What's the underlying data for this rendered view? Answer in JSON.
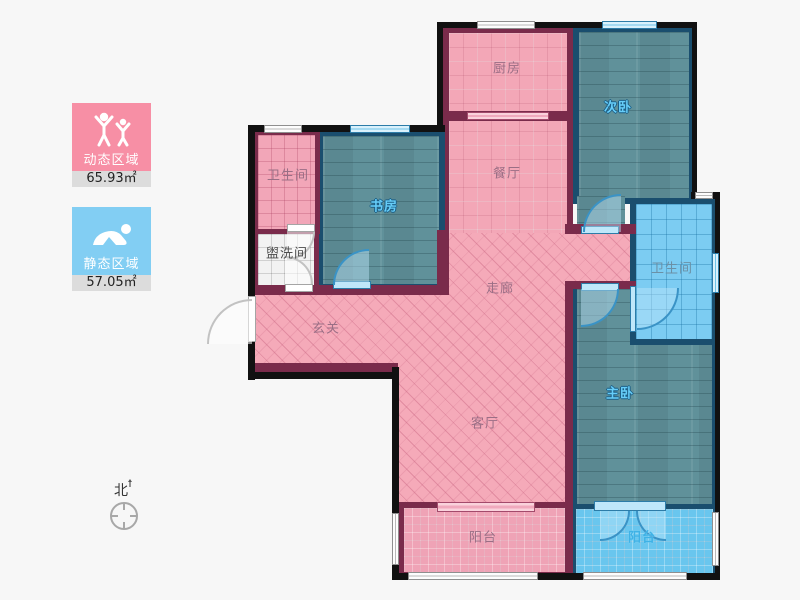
{
  "legend": {
    "dynamic": {
      "label": "动态区域",
      "area": "65.93㎡",
      "color": "#f78fa5",
      "icon": "people-active-icon"
    },
    "static": {
      "label": "静态区域",
      "area": "57.05㎡",
      "color": "#82cef3",
      "icon": "person-resting-icon"
    }
  },
  "compass": {
    "north_label": "北"
  },
  "rooms": {
    "kitchen": {
      "label": "厨房"
    },
    "dining": {
      "label": "餐厅"
    },
    "bedroom_second": {
      "label": "次卧"
    },
    "bathroom_top": {
      "label": "卫生间"
    },
    "study": {
      "label": "书房"
    },
    "washroom": {
      "label": "盥洗间"
    },
    "corridor": {
      "label": "走廊"
    },
    "entry": {
      "label": "玄关"
    },
    "bathroom_right": {
      "label": "卫生间"
    },
    "living": {
      "label": "客厅"
    },
    "bedroom_master": {
      "label": "主卧"
    },
    "balcony_left": {
      "label": "阳台"
    },
    "balcony_right": {
      "label": "阳台"
    }
  },
  "colors": {
    "dynamic_zone": "#f78fa5",
    "static_zone": "#82cef3",
    "wall_dark_red": "#7a2b4b",
    "wall_navy": "#1a4e6e",
    "outline": "#111111",
    "background": "#f7f7f7"
  }
}
